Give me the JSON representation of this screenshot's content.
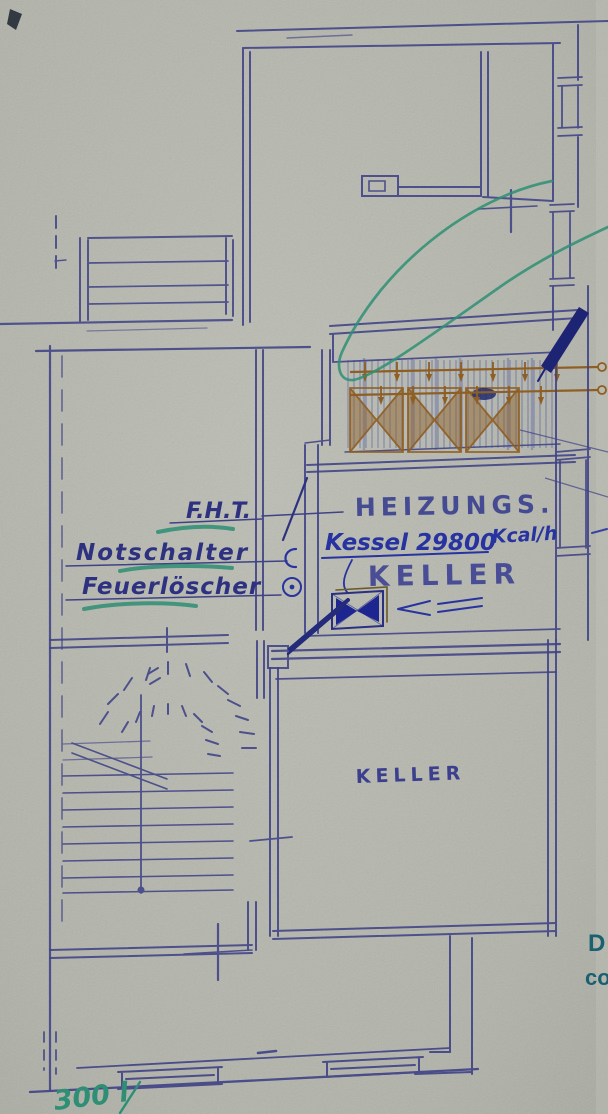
{
  "labels": {
    "fht": "F.H.T.",
    "notschalter": "Notschalter",
    "feuerloescher": "Feuerlöscher",
    "heizungs": "HEIZUNGS.",
    "kessel": "Kessel 29800",
    "kessel_unit": "Kcal/h",
    "heizungskeller_room": "KELLER",
    "keller_room": "KELLER",
    "edge_partial_top": "D",
    "edge_partial_bottom": "co",
    "green_note": "300 l"
  },
  "colors": {
    "paper": "#b3b5ab",
    "pencil_blue": "#3f4286",
    "ink_blue": "#2733a0",
    "label_ink": "#2d3180",
    "ochre": "#8f5e22",
    "teal_marker": "#2e8f74",
    "print_teal": "#1a6070"
  },
  "symbols": [
    "heating-window-hatch-icon",
    "valve-bowtie-icon",
    "left-arrow-icon",
    "notschalter-switch-icon",
    "feuerloescher-circle-icon",
    "winding-staircase-icon",
    "teal-highlight-loop-icon"
  ]
}
